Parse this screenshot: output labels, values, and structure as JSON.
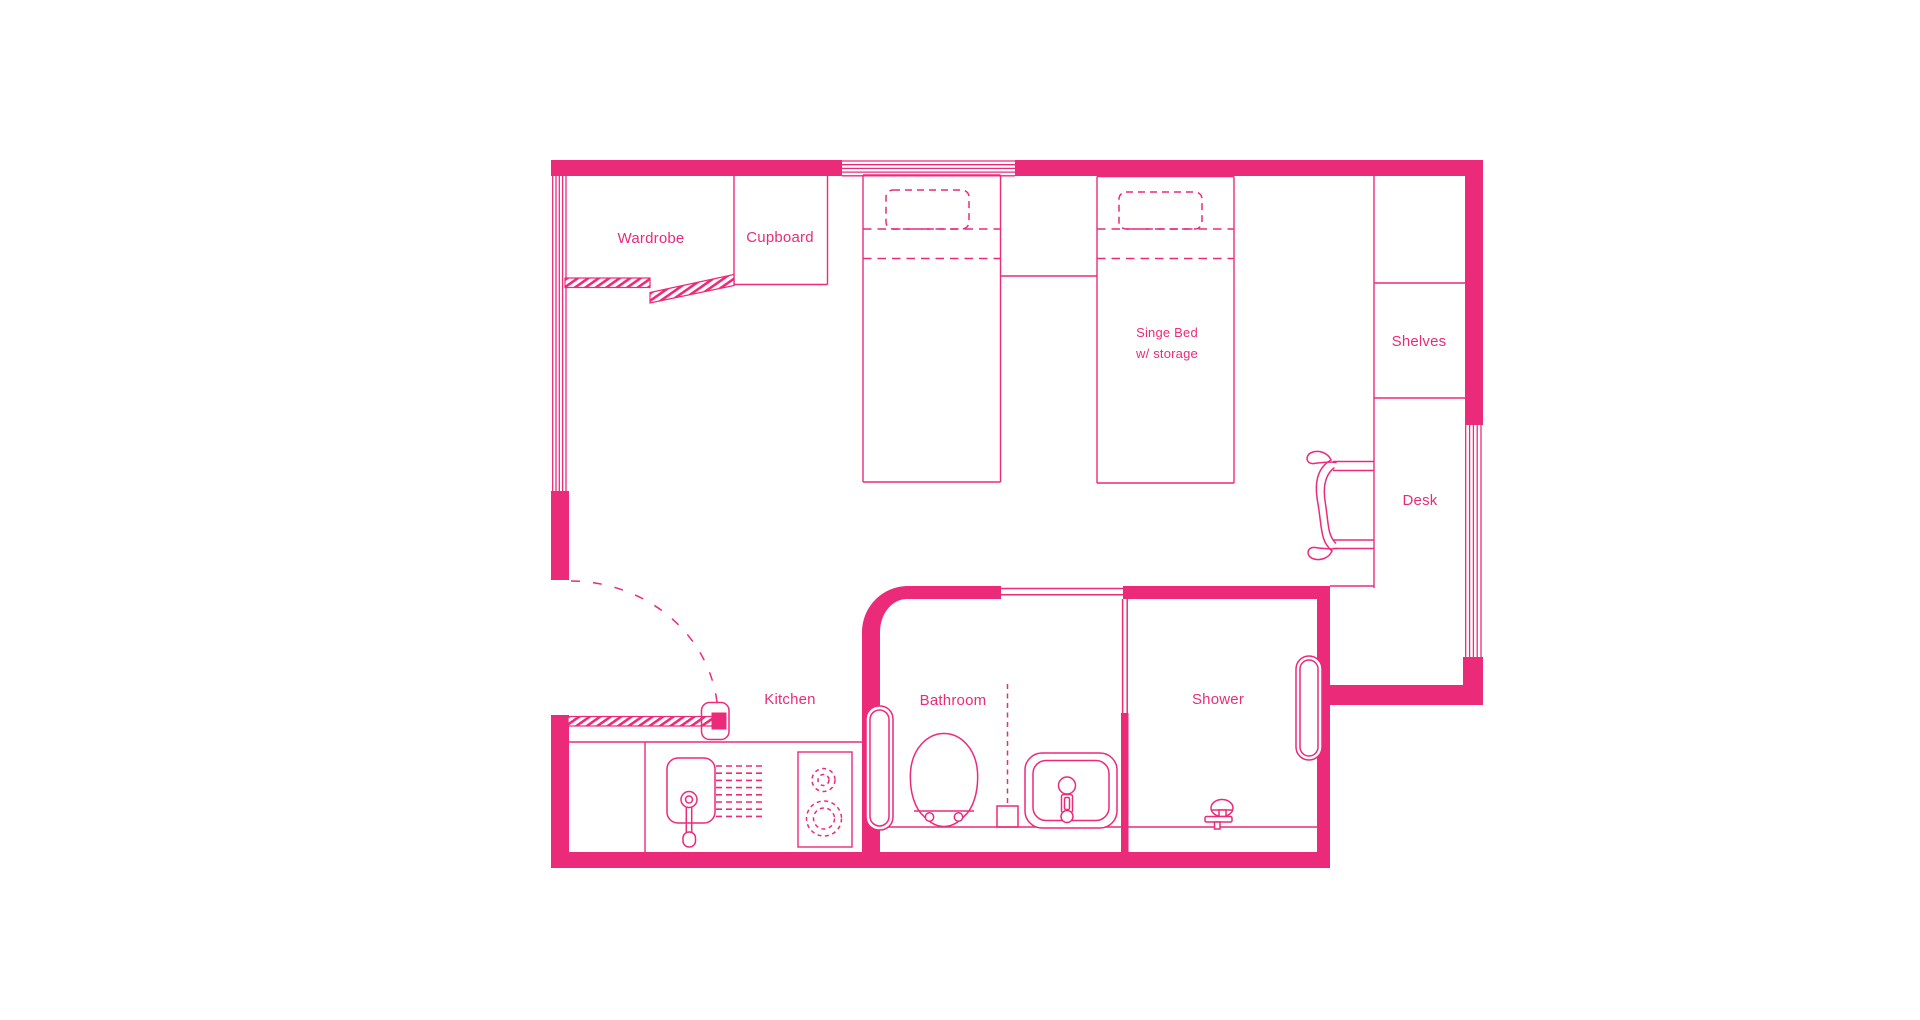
{
  "document": {
    "type": "studio-apartment-floor-plan"
  },
  "colors": {
    "accent": "#EC2A7A",
    "background": "#FFFFFF"
  },
  "plan": {
    "labels": {
      "wardrobe": "Wardrobe",
      "cupboard": "Cupboard",
      "single_bed_1": "Singe Bed",
      "single_bed_2": "w/ storage",
      "shelves": "Shelves",
      "desk": "Desk",
      "kitchen": "Kitchen",
      "bathroom": "Bathroom",
      "shower": "Shower"
    },
    "features": [
      "top-window",
      "left-window",
      "right-window",
      "entry-door-swing",
      "bathroom-door",
      "shower-door",
      "bed-1",
      "bed-2",
      "toilet",
      "bathroom-sink",
      "towel-rail",
      "kitchen-sink",
      "drying-rack",
      "stove",
      "shower-head",
      "desk-chair",
      "wardrobe-sliding-rails"
    ]
  }
}
